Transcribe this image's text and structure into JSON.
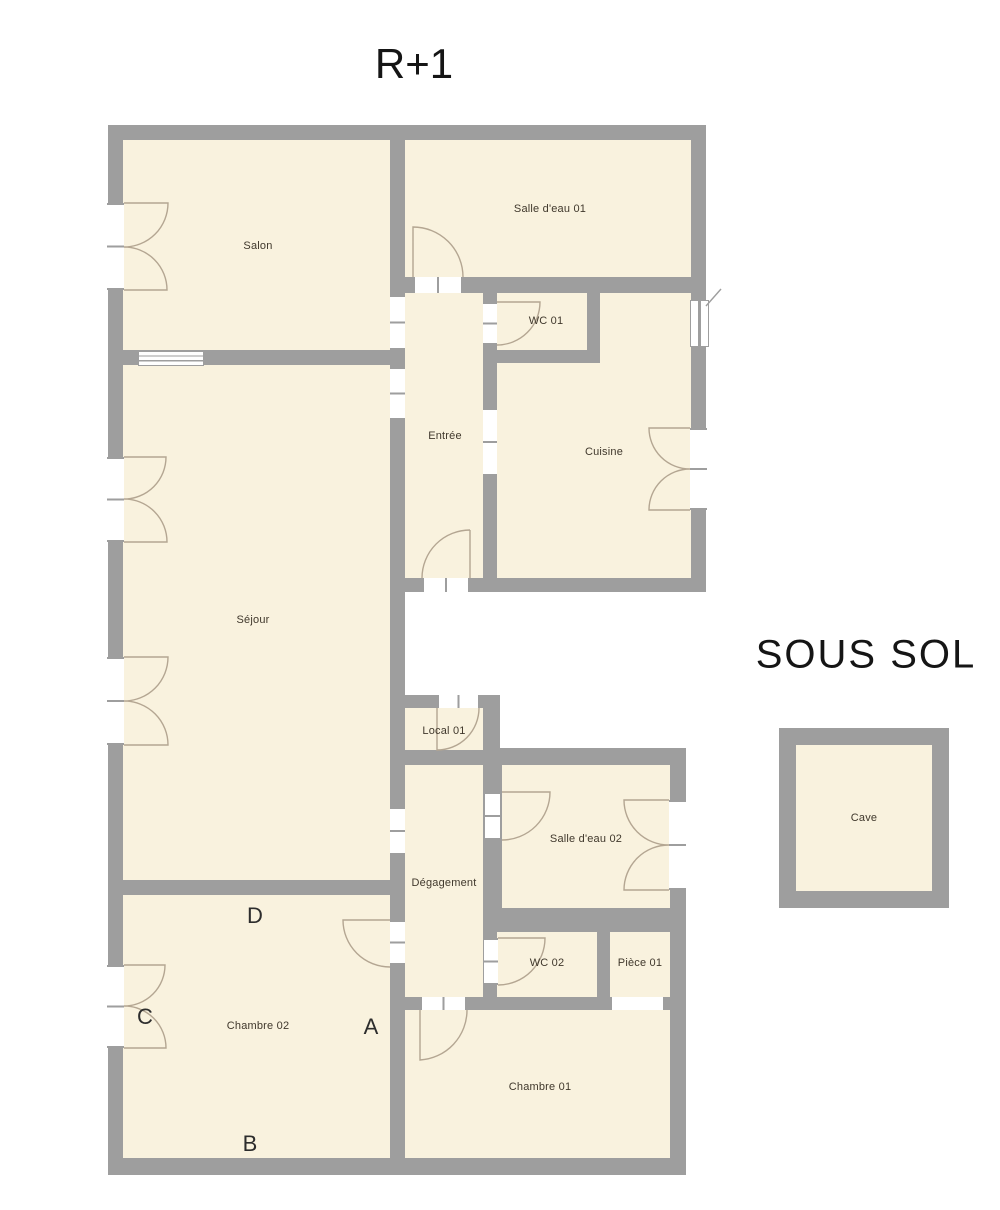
{
  "colors": {
    "background": "#ffffff",
    "wall": "#9e9e9e",
    "floor": "#f9f2de",
    "arc": "#b4a692",
    "text": "#40382c",
    "marker": "#2d2d2d",
    "title": "#151515"
  },
  "titles": {
    "upper_floor": "R+1",
    "basement": "SOUS SOL"
  },
  "rooms": [
    {
      "id": "salon",
      "label": "Salon"
    },
    {
      "id": "salle-deau-01",
      "label": "Salle d'eau 01"
    },
    {
      "id": "wc-01",
      "label": "WC 01"
    },
    {
      "id": "entree",
      "label": "Entrée"
    },
    {
      "id": "cuisine",
      "label": "Cuisine"
    },
    {
      "id": "sejour",
      "label": "Séjour"
    },
    {
      "id": "local-01",
      "label": "Local 01"
    },
    {
      "id": "degagement",
      "label": "Dégagement"
    },
    {
      "id": "salle-deau-02",
      "label": "Salle d'eau 02"
    },
    {
      "id": "wc-02",
      "label": "WC 02"
    },
    {
      "id": "piece-01",
      "label": "Pièce 01"
    },
    {
      "id": "chambre-02",
      "label": "Chambre 02"
    },
    {
      "id": "chambre-01",
      "label": "Chambre 01"
    },
    {
      "id": "cave",
      "label": "Cave"
    }
  ],
  "markers": [
    {
      "label": "A"
    },
    {
      "label": "B"
    },
    {
      "label": "C"
    },
    {
      "label": "D"
    }
  ]
}
